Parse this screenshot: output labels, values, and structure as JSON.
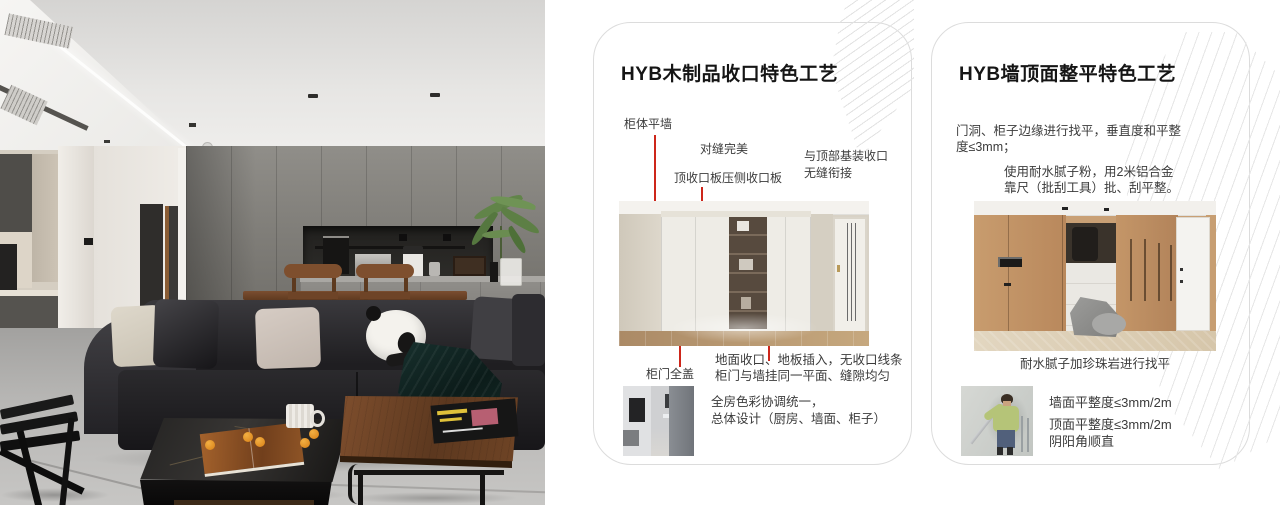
{
  "theme": {
    "accent_red": "#cd261a",
    "card_border": "#dcdcdc",
    "pattern_line": "#e4e4e4",
    "title_color": "#151515",
    "text_color": "#3b3b3b",
    "page_bg": "#ffffff"
  },
  "card1": {
    "title": "HYB木制品收口特色工艺",
    "callout_cabinet_wall": "柜体平墙",
    "callout_seam": "对缝完美",
    "callout_top_panel": "顶收口板压侧收口板",
    "callout_ceiling_1": "与顶部基装收口",
    "callout_ceiling_2": "无缝衔接",
    "callout_door_cover": "柜门全盖",
    "note_1": "地面收口、地板插入，无收口线条",
    "note_2": "柜门与墙挂同一平面、缝隙均匀",
    "summary_1": "全房色彩协调统一，",
    "summary_2": "总体设计（厨房、墙面、柜子）"
  },
  "card2": {
    "title": "HYB墙顶面整平特色工艺",
    "para1_1": "门洞、柜子边缘进行找平，垂直度和平整",
    "para1_2": "度≤3mm；",
    "para2_1": "使用耐水腻子粉，用2米铝合金",
    "para2_2": "靠尺（批刮工具）批、刮平整。",
    "caption": "耐水腻子加珍珠岩进行找平",
    "spec_1": "墙面平整度≤3mm/2m",
    "spec_2": "顶面平整度≤3mm/2m",
    "spec_3": "阴阳角顺直"
  }
}
